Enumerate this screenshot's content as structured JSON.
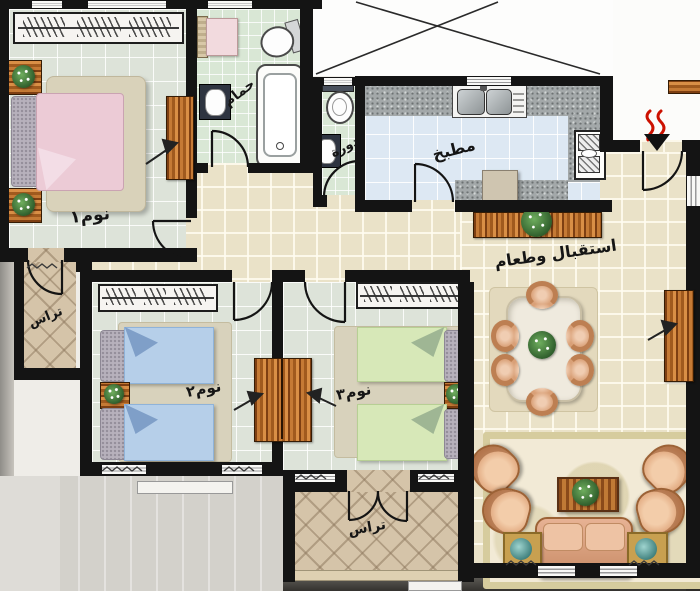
{
  "plan": {
    "type": "residential-apartment-floor-plan",
    "labels_language": "Arabic",
    "rooms": [
      {
        "id": "bedroom-1",
        "label": "نوم١"
      },
      {
        "id": "bathroom",
        "label": "حمام"
      },
      {
        "id": "wc",
        "label": "دورة"
      },
      {
        "id": "kitchen",
        "label": "مطبخ"
      },
      {
        "id": "reception-dining",
        "label": "استقبال وطعام"
      },
      {
        "id": "bedroom-2",
        "label": "نوم٢"
      },
      {
        "id": "bedroom-3",
        "label": "نوم٣"
      },
      {
        "id": "terrace-west",
        "label": "تراس"
      },
      {
        "id": "terrace-south",
        "label": "تراس"
      }
    ],
    "colors": {
      "wall": "#141414",
      "bedroom_floor": "#dde3d9",
      "bathroom_floor": "#d9e7d5",
      "kitchen_floor": "#dde8f3",
      "hall_floor": "#eae2c8",
      "terrace_floor": "#d5c4a9",
      "bed1": "#eccbd6",
      "bed2": "#b6cfe9",
      "bed3": "#d7e8b8",
      "sofa": "#dba183",
      "wood": "#a85f26",
      "entrance_marker": "#cc1100"
    }
  }
}
